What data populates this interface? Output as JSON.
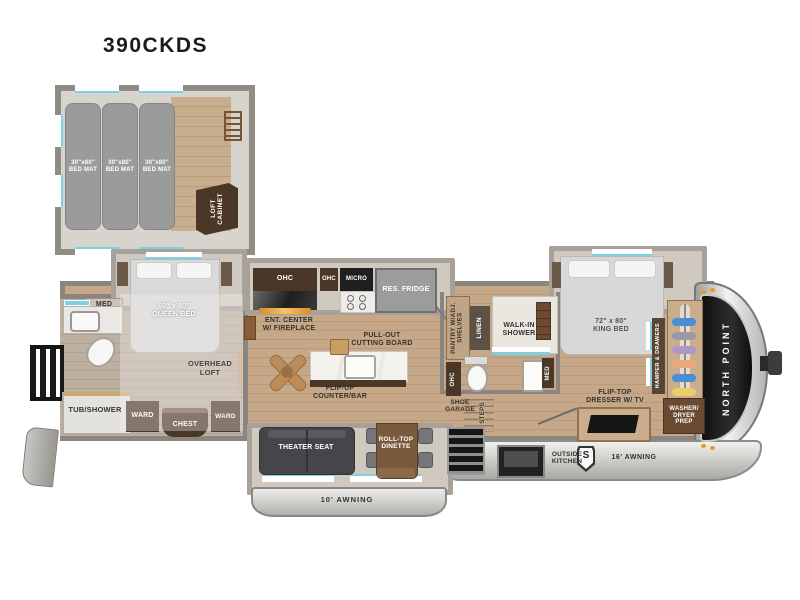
{
  "title": "390CKDS",
  "colors": {
    "accent_cyan": "#7fd0e2",
    "wood": "#c6a788",
    "cabinet_brown": "#4a3727",
    "cap_black": "#1b1b1b",
    "awning_silver": "#d8d8d6"
  },
  "loft": {
    "bed_mats": [
      "30\"x80\"\nBED MAT",
      "30\"x80\"\nBED MAT",
      "30\"x80\"\nBED MAT"
    ],
    "cabinet_label": "LOFT\nCABINET"
  },
  "bedroom": {
    "med": "MED",
    "queen_bed": "60\" x 80\"\nQUEEN BED",
    "overhead_loft": "OVERHEAD\nLOFT",
    "tub_shower": "TUB/SHOWER",
    "ward_left": "WARD",
    "chest": "CHEST",
    "ward_right": "WARD"
  },
  "kitchen": {
    "ohc_long": "OHC",
    "ohc_small": "OHC",
    "micro": "MICRO",
    "fridge": "RES. FRIDGE",
    "ent_center": "ENT. CENTER\nW/ FIREPLACE",
    "cutting_board": "PULL-OUT\nCUTTING BOARD",
    "counter_bar": "FLIP-UP\nCOUNTER/BAR"
  },
  "mid_bath": {
    "pantry": "PANTRY W/ADJ.\nSHELVES",
    "linen": "LINEN",
    "shower": "WALK-IN\nSHOWER",
    "ohc": "OHC",
    "med": "MED",
    "shoe_garage": "SHOE\nGARAGE",
    "steps": "STEPS"
  },
  "master": {
    "king_bed": "72\" x 80\"\nKING BED",
    "hamper": "HAMPER & DRAWERS",
    "dresser": "FLIP-TOP\nDRESSER W/ TV",
    "washer_dryer": "WASHER/\nDRYER\nPREP",
    "brand": "NORTH POINT"
  },
  "living": {
    "theater_seat": "THEATER SEAT",
    "dinette": "ROLL-TOP\nDINETTE"
  },
  "exterior": {
    "awning_left": "10' AWNING",
    "awning_right": "16' AWNING",
    "outside_kitchen": "OUTSIDE\nKITCHEN",
    "solar_badge": "S"
  }
}
